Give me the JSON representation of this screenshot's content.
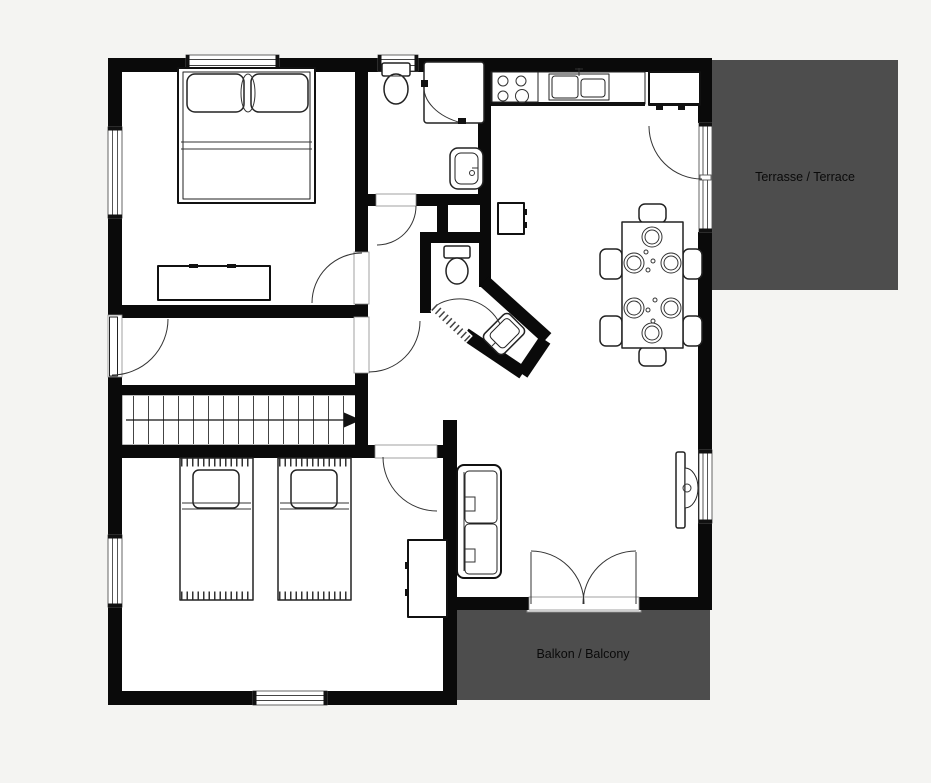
{
  "canvas": {
    "width": 931,
    "height": 783,
    "background": "#f4f4f2"
  },
  "colors": {
    "wall": "#0a0a0a",
    "floor": "#ffffff",
    "outdoor_area": "#4d4d4d",
    "outline": "#222222",
    "label_text": "#0a0a0a"
  },
  "areas": {
    "terrace": {
      "label": "Terrasse / Terrace"
    },
    "balcony": {
      "label": "Balkon / Balcony"
    }
  },
  "stairs": {
    "arrow_direction": "right"
  },
  "furniture_symbols": [
    "double-bed",
    "pillow",
    "dresser",
    "toilet",
    "corner-shower",
    "washbasin",
    "corner-washbasin",
    "service-shaft",
    "stove-4-burners",
    "kitchen-sink",
    "kitchen-counter",
    "kitchen-cabinet",
    "mini-cabinet",
    "dining-table",
    "dining-chair",
    "plate",
    "sofa",
    "wall-tv",
    "single-bed",
    "wardrobe",
    "stairs-up-arrow",
    "door-swing",
    "window",
    "french-doors"
  ]
}
